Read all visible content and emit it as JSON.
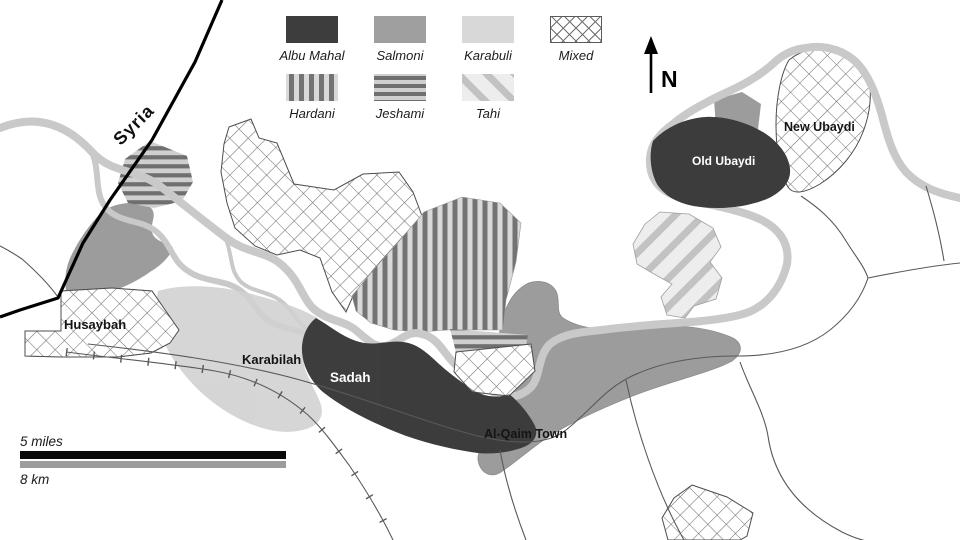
{
  "legend": {
    "items": [
      {
        "label": "Albu Mahal",
        "pattern": "solid-dark"
      },
      {
        "label": "Salmoni",
        "pattern": "solid-medium"
      },
      {
        "label": "Karabuli",
        "pattern": "solid-light"
      },
      {
        "label": "Mixed",
        "pattern": "crosshatch"
      },
      {
        "label": "Hardani",
        "pattern": "vertical-stripes"
      },
      {
        "label": "Jeshami",
        "pattern": "horizontal-stripes"
      },
      {
        "label": "Tahi",
        "pattern": "diagonal-stripes"
      }
    ]
  },
  "compass": {
    "label": "N"
  },
  "places": {
    "syria": "Syria",
    "husaybah": "Husaybah",
    "karabilah": "Karabilah",
    "sadah": "Sadah",
    "al_qaim_town": "Al-Qaim Town",
    "old_ubaydi": "Old Ubaydi",
    "new_ubaydi": "New Ubaydi"
  },
  "scale_bar": {
    "miles": "5 miles",
    "km": "8 km"
  },
  "attribution": "© ATAG International, 2022",
  "colors": {
    "albu_mahal": "#3d3d3d",
    "salmoni": "#9c9c9c",
    "karabuli": "#d6d6d6",
    "river": "#c9c9c9",
    "road": "#595959",
    "border": "#000000",
    "attribution_text": "#9e9e9e"
  }
}
